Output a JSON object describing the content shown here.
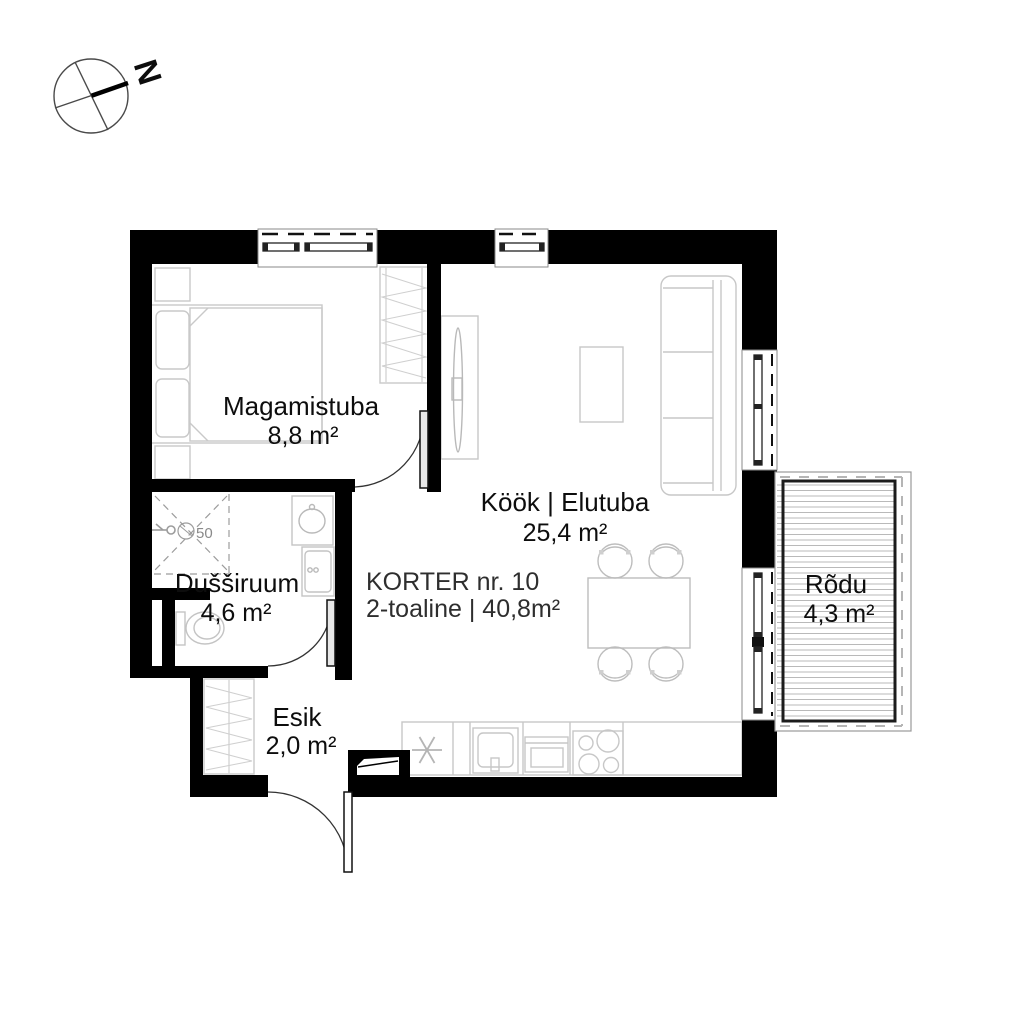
{
  "compass": {
    "north_label": "N"
  },
  "title_block": {
    "line1": "KORTER nr. 10",
    "line2": "2-toaline | 40,8m²"
  },
  "rooms": [
    {
      "id": "magamistuba",
      "name": "Magamistuba",
      "area": "8,8 m²"
    },
    {
      "id": "dussiruum",
      "name": "Dušširuum",
      "area": "4,6 m²"
    },
    {
      "id": "esik",
      "name": "Esik",
      "area": "2,0 m²"
    },
    {
      "id": "kook-elutuba",
      "name": "Köök | Elutuba",
      "area": "25,4 m²"
    },
    {
      "id": "rodu",
      "name": "Rõdu",
      "area": "4,3 m²"
    }
  ],
  "annotations": {
    "floor_drain": "50"
  },
  "colors": {
    "wall": "#000000",
    "furniture_line": "#c9c9c9",
    "text": "#0d0d0d",
    "background": "#ffffff"
  }
}
